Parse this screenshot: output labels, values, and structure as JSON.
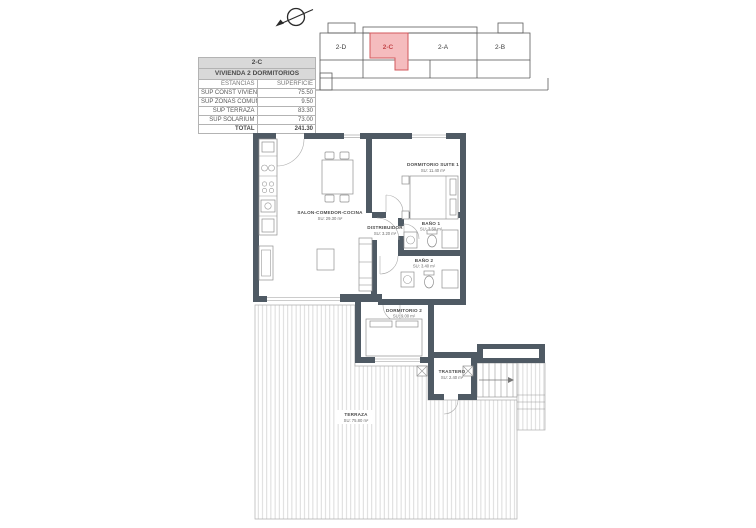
{
  "info_table": {
    "unit": "2-C",
    "subtitle": "VIVIENDA 2 DORMITORIOS",
    "col_headers": [
      "ESTANCIAS",
      "SUPERFICIE"
    ],
    "rows": [
      {
        "label": "SUP CONST VIVIENDA",
        "value": "75.50"
      },
      {
        "label": "SUP ZONAS COMUNES",
        "value": "9.50"
      },
      {
        "label": "SUP TERRAZA",
        "value": "83.30"
      },
      {
        "label": "SUP SOLARIUM",
        "value": "73.00"
      },
      {
        "label": "TOTAL",
        "value": "241.30"
      }
    ]
  },
  "key_plan": {
    "units": [
      {
        "label": "2-D"
      },
      {
        "label": "2-C"
      },
      {
        "label": "2-A"
      },
      {
        "label": "2-B"
      }
    ],
    "highlighted_unit": "2-C",
    "highlight_fill": "#f5bcbe",
    "highlight_border": "#d2595c"
  },
  "floor_plan": {
    "wall_color": "#4f5a64",
    "rooms": [
      {
        "name": "SALON-COMEDOR-COCINA",
        "area": "SU: 29.30 m²"
      },
      {
        "name": "DORMITORIO SUITE 1",
        "area": "SU: 11.40 m²"
      },
      {
        "name": "DISTRIBUIDOR",
        "area": "SU: 3.20 m²"
      },
      {
        "name": "BAÑO 1",
        "area": "SU: 3.50 m²"
      },
      {
        "name": "BAÑO 2",
        "area": "SU: 3.40 m²"
      },
      {
        "name": "DORMITORIO 2",
        "area": "SU: 9.00 m²"
      },
      {
        "name": "TRASTERO",
        "area": "SU: 2.40 m²"
      },
      {
        "name": "TERRAZA",
        "area": "SU: 75.80 m²"
      }
    ]
  },
  "icons": {
    "compass": "north-arrow"
  }
}
